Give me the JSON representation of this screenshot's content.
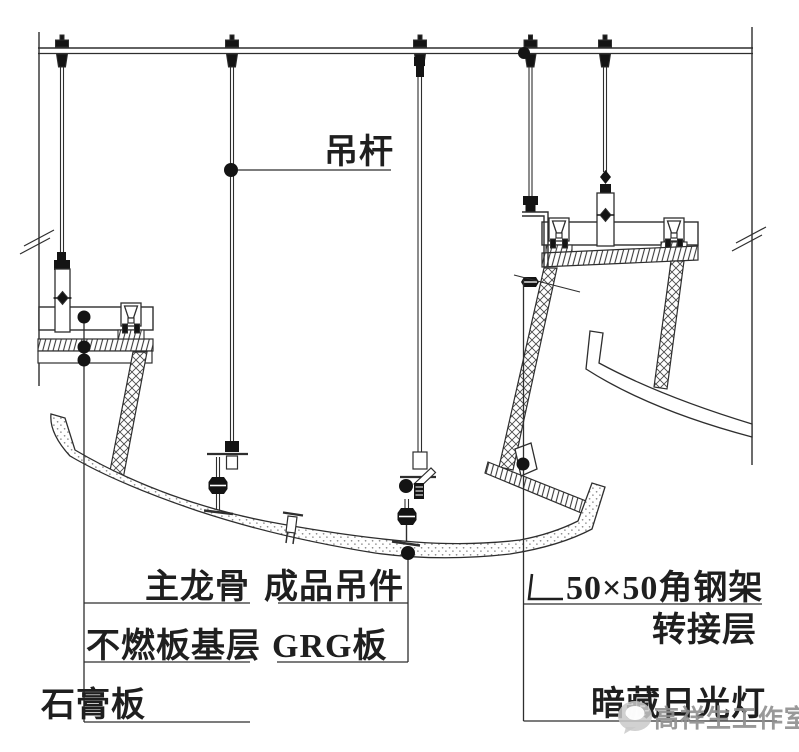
{
  "drawing_type": "ceiling-suspension-construction-detail",
  "labels": {
    "hanger_rod": "吊杆",
    "main_keel": "主龙骨",
    "finished_hanger": "成品吊件",
    "noncombustible_board_base": "不燃板基层",
    "grg_board": "GRG板",
    "gypsum_board": "石膏板",
    "angle_symbol": "∟",
    "angle_steel_frame": "50×50角钢架",
    "transfer_layer": "转接层",
    "concealed_fluorescent_lamp": "暗藏日光灯"
  },
  "watermark": {
    "studio": "高祥生工作室"
  },
  "colors": {
    "line": "#2e2e2e",
    "solid_black": "#141414",
    "background": "#ffffff",
    "watermark_gray": "#8f8f8f"
  }
}
